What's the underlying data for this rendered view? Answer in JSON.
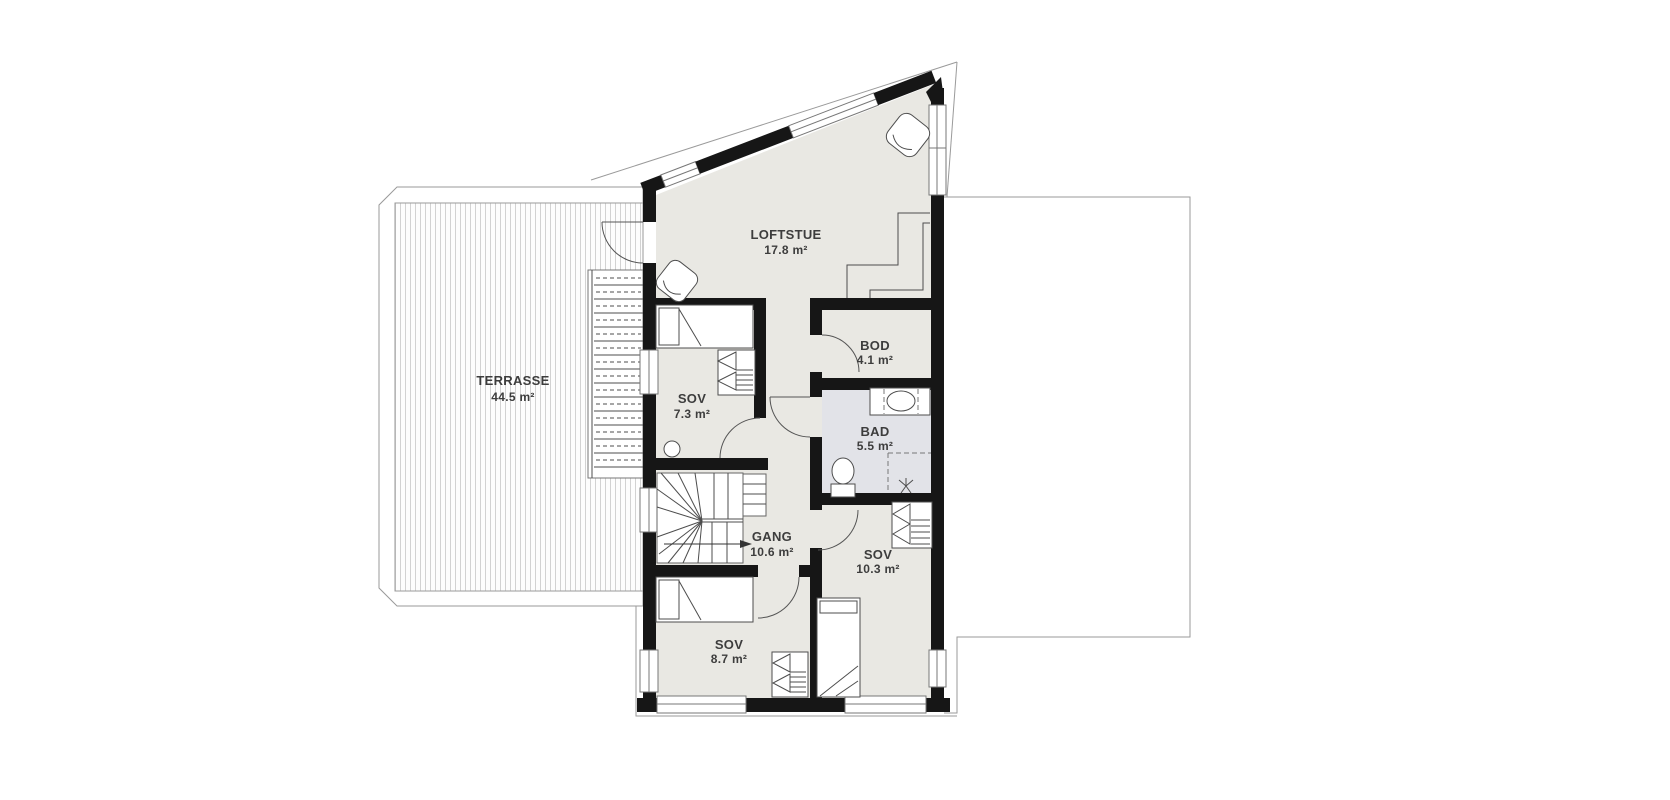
{
  "plan": {
    "type": "floor-plan",
    "floor": "loft",
    "colors": {
      "wall": "#161616",
      "floor": "#e9e8e3",
      "bathroom_floor": "#e2e3e8",
      "outline": "#9a9a9a",
      "label_text": "#3d3d3d"
    }
  },
  "rooms": {
    "terrasse": {
      "name": "TERRASSE",
      "area": "44.5 m²"
    },
    "loftstue": {
      "name": "LOFTSTUE",
      "area": "17.8 m²"
    },
    "sov1": {
      "name": "SOV",
      "area": "7.3 m²"
    },
    "bod": {
      "name": "BOD",
      "area": "4.1 m²"
    },
    "bad": {
      "name": "BAD",
      "area": "5.5 m²"
    },
    "gang": {
      "name": "GANG",
      "area": "10.6 m²"
    },
    "sov2": {
      "name": "SOV",
      "area": "10.3 m²"
    },
    "sov3": {
      "name": "SOV",
      "area": "8.7 m²"
    }
  }
}
